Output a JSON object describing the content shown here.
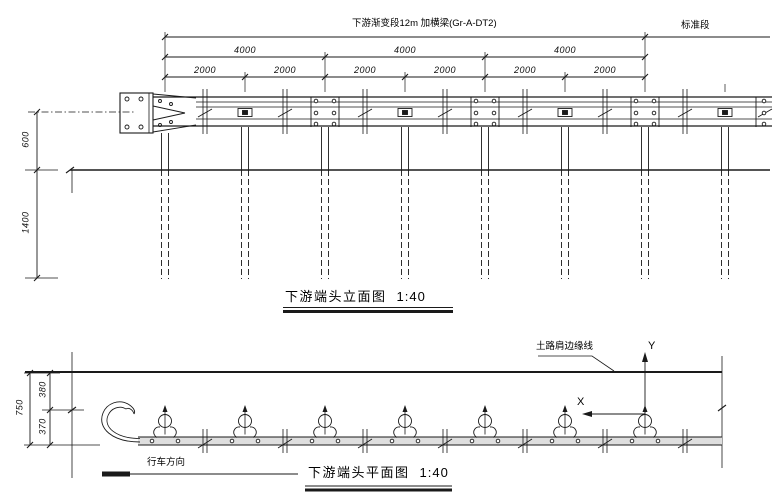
{
  "colors": {
    "line": "#1a1a1a",
    "rail_fill": "#dedede"
  },
  "drawing": {
    "top_note": "下游渐变段12m 加横梁(Gr-A-DT2)",
    "standard_section_label": "标准段",
    "elevation": {
      "title": "下游端头立面图",
      "scale": "1:40",
      "dim_4000": [
        "4000",
        "4000",
        "4000"
      ],
      "dim_2000": [
        "2000",
        "2000",
        "2000",
        "2000",
        "2000",
        "2000"
      ],
      "dim_rail_height": "600",
      "dim_embed_depth": "1400"
    },
    "plan": {
      "title": "下游端头平面图",
      "scale": "1:40",
      "shoulder_edge_label": "土路肩边缘线",
      "travel_direction_label": "行车方向",
      "axis_x": "X",
      "axis_y": "Y",
      "dim_total": "750",
      "dim_upper": "380",
      "dim_lower": "370"
    }
  }
}
